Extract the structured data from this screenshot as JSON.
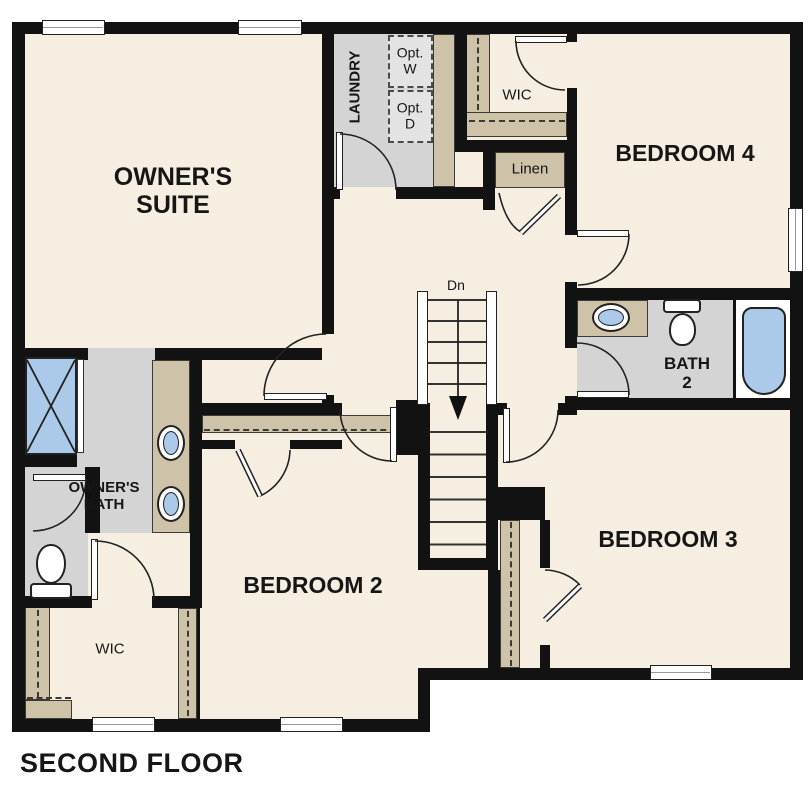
{
  "title": "SECOND FLOOR",
  "rooms": {
    "owners_suite": {
      "line1": "OWNER'S",
      "line2": "SUITE"
    },
    "laundry": {
      "label": "LAUNDRY"
    },
    "opt_washer": {
      "line1": "Opt.",
      "line2": "W"
    },
    "opt_dryer": {
      "line1": "Opt.",
      "line2": "D"
    },
    "wic_upper": {
      "label": "WIC"
    },
    "linen": {
      "label": "Linen"
    },
    "bedroom4": {
      "label": "BEDROOM 4"
    },
    "bath2": {
      "line1": "BATH",
      "line2": "2"
    },
    "stairs": {
      "label": "Dn"
    },
    "owners_bath": {
      "line1": "OWNER'S",
      "line2": "BATH"
    },
    "wic_owners": {
      "label": "WIC"
    },
    "bedroom2": {
      "label": "BEDROOM 2"
    },
    "bedroom3": {
      "label": "BEDROOM 3"
    }
  },
  "colors": {
    "wall": "#121212",
    "floor": "#f6eee1",
    "tan": "#cec2a8",
    "gray": "#d4d4d4",
    "blue": "#abc9e8",
    "outline": "#222222"
  }
}
